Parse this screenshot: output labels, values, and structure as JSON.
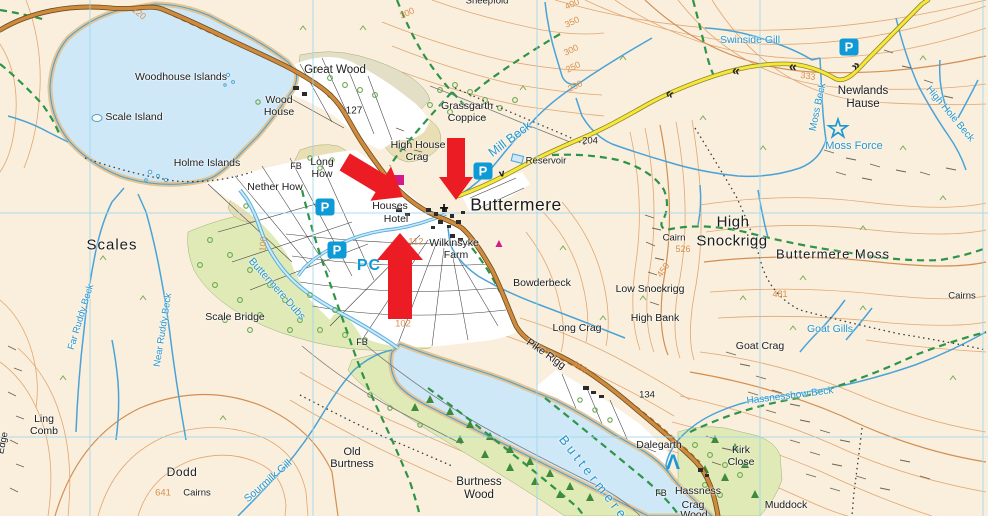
{
  "colors": {
    "land": "#f9efdc",
    "water": "#cfe8f7",
    "water_line": "#4aa3d8",
    "shore_tan": "#e4c493",
    "wood_green": "#dfeab6",
    "wood_grey": "#e2dfc6",
    "knoll_tan": "#e9deb4",
    "contour": "#e2a26c",
    "contour_index": "#d18a4c",
    "road_fill": "#cf8a3d",
    "road_casing": "#6b4d1e",
    "yellow_road": "#f6e83a",
    "yellow_casing": "#8f8526",
    "bridleway_green": "#2e9447",
    "footpath_black": "#3a3a3a",
    "grid_blue": "#99d6ee",
    "field_white": "#ffffff",
    "building_black": "#2b2b2b",
    "parking_blue": "#0e9ad6",
    "magenta": "#d31a8a",
    "arrow_red": "#ec1c24"
  },
  "labels": [
    {
      "t": "Woodhouse Islands",
      "x": 181,
      "y": 77
    },
    {
      "t": "Scale Island",
      "x": 134,
      "y": 117
    },
    {
      "t": "Holme Islands",
      "x": 207,
      "y": 163
    },
    {
      "t": "Wood",
      "x": 279,
      "y": 100
    },
    {
      "t": "House",
      "x": 279,
      "y": 112
    },
    {
      "t": "Great Wood",
      "x": 335,
      "y": 70,
      "s": 11.5
    },
    {
      "t": "127",
      "x": 354,
      "y": 111,
      "s": 10
    },
    {
      "t": "Grassgarth",
      "x": 467,
      "y": 106
    },
    {
      "t": "Coppice",
      "x": 467,
      "y": 118
    },
    {
      "t": "High House",
      "x": 418,
      "y": 145
    },
    {
      "t": "Crag",
      "x": 417,
      "y": 157
    },
    {
      "t": "Long",
      "x": 322,
      "y": 162
    },
    {
      "t": "How",
      "x": 322,
      "y": 174
    },
    {
      "t": "FB",
      "x": 296,
      "y": 166,
      "s": 9
    },
    {
      "t": "Nether How",
      "x": 275,
      "y": 187
    },
    {
      "t": "Houses",
      "x": 390,
      "y": 206
    },
    {
      "t": "Hotel",
      "x": 396,
      "y": 219
    },
    {
      "t": "Buttermere",
      "x": 516,
      "y": 205,
      "s": 17.5,
      "ls": 0.5
    },
    {
      "t": "Wilkinsyke",
      "x": 454,
      "y": 243
    },
    {
      "t": "Farm",
      "x": 456,
      "y": 255
    },
    {
      "t": "Bowderbeck",
      "x": 542,
      "y": 283
    },
    {
      "t": "Reservoir",
      "x": 546,
      "y": 161,
      "s": 9.5
    },
    {
      "t": "204",
      "x": 590,
      "y": 141,
      "s": 9.5
    },
    {
      "t": "Swinside Gill",
      "x": 750,
      "y": 40,
      "cls": "water"
    },
    {
      "t": "Newlands",
      "x": 863,
      "y": 91,
      "s": 11.5
    },
    {
      "t": "Hause",
      "x": 863,
      "y": 104,
      "s": 11.5
    },
    {
      "t": "Moss Force",
      "x": 854,
      "y": 146,
      "cls": "water",
      "s": 11
    },
    {
      "t": "Moss Beck",
      "x": 818,
      "y": 107,
      "cls": "water",
      "s": 10,
      "r": -78
    },
    {
      "t": "High Hole Beck",
      "x": 950,
      "y": 114,
      "cls": "water",
      "s": 10,
      "r": 50
    },
    {
      "t": "High",
      "x": 733,
      "y": 222,
      "s": 15,
      "ls": 0.5
    },
    {
      "t": "Snockrigg",
      "x": 732,
      "y": 241,
      "s": 15,
      "ls": 0.5
    },
    {
      "t": "Cairn",
      "x": 674,
      "y": 238,
      "s": 9.5
    },
    {
      "t": "Buttermere Moss",
      "x": 833,
      "y": 254,
      "s": 13,
      "ls": 1
    },
    {
      "t": "Cairns",
      "x": 962,
      "y": 296,
      "s": 9.5
    },
    {
      "t": "Goat Gills",
      "x": 830,
      "y": 329,
      "cls": "water"
    },
    {
      "t": "Goat Crag",
      "x": 760,
      "y": 346
    },
    {
      "t": "Low Snockrigg",
      "x": 650,
      "y": 289
    },
    {
      "t": "High Bank",
      "x": 655,
      "y": 318
    },
    {
      "t": "Long Crag",
      "x": 577,
      "y": 328
    },
    {
      "t": "Pike Rigg",
      "x": 546,
      "y": 354,
      "r": 35
    },
    {
      "t": "134",
      "x": 647,
      "y": 395,
      "s": 9.5
    },
    {
      "t": "Scale Bridge",
      "x": 235,
      "y": 317
    },
    {
      "t": "Scales",
      "x": 112,
      "y": 245,
      "s": 15,
      "ls": 1
    },
    {
      "t": "Buttermere Dubs",
      "x": 277,
      "y": 289,
      "cls": "water",
      "r": 48
    },
    {
      "t": "Far Ruddy Beck",
      "x": 81,
      "y": 317,
      "cls": "water",
      "s": 9.5,
      "r": -73
    },
    {
      "t": "Near Ruddy Beck",
      "x": 163,
      "y": 330,
      "cls": "water",
      "s": 9.5,
      "r": -81
    },
    {
      "t": "Sourmilk Gill",
      "x": 268,
      "y": 481,
      "cls": "water",
      "r": -41
    },
    {
      "t": "Ling",
      "x": 44,
      "y": 419
    },
    {
      "t": "Comb",
      "x": 44,
      "y": 431
    },
    {
      "t": "Dodd",
      "x": 182,
      "y": 472,
      "s": 12,
      "ls": 0.5
    },
    {
      "t": "641",
      "x": 163,
      "y": 493,
      "cls": "contour-lbl",
      "s": 9.5
    },
    {
      "t": "Cairns",
      "x": 197,
      "y": 493,
      "s": 9.5
    },
    {
      "t": "Old",
      "x": 352,
      "y": 452,
      "s": 11
    },
    {
      "t": "Burtness",
      "x": 352,
      "y": 464,
      "s": 11
    },
    {
      "t": "Burtness",
      "x": 479,
      "y": 482,
      "s": 11.5
    },
    {
      "t": "Wood",
      "x": 479,
      "y": 495,
      "s": 11.5
    },
    {
      "t": "Buttermere",
      "x": 594,
      "y": 478,
      "cls": "water",
      "s": 13,
      "r": 52,
      "ls": 4
    },
    {
      "t": "Dalegarth",
      "x": 659,
      "y": 445
    },
    {
      "t": "FB",
      "x": 661,
      "y": 493,
      "s": 9
    },
    {
      "t": "Hassness",
      "x": 698,
      "y": 491
    },
    {
      "t": "Crag",
      "x": 693,
      "y": 505
    },
    {
      "t": "Wood",
      "x": 694,
      "y": 515
    },
    {
      "t": "Muddock",
      "x": 786,
      "y": 505
    },
    {
      "t": "Kirk",
      "x": 741,
      "y": 450
    },
    {
      "t": "Close",
      "x": 741,
      "y": 462
    },
    {
      "t": "Hassnesshow Beck",
      "x": 790,
      "y": 396,
      "cls": "water",
      "s": 10,
      "r": -7
    },
    {
      "t": "PC",
      "x": 369,
      "y": 266,
      "cls": "blue-label",
      "s": 16,
      "ls": 1
    },
    {
      "t": "112",
      "x": 416,
      "y": 242,
      "cls": "contour-lbl",
      "s": 9.5
    },
    {
      "t": "102",
      "x": 403,
      "y": 324,
      "cls": "contour-lbl",
      "s": 9.5
    },
    {
      "t": "100",
      "x": 263,
      "y": 244,
      "cls": "contour-lbl",
      "s": 9,
      "r": -85
    },
    {
      "t": "120",
      "x": 139,
      "y": 13,
      "cls": "contour-lbl",
      "s": 9,
      "r": 38
    },
    {
      "t": "120",
      "x": 580,
      "y": 367,
      "cls": "contour-lbl",
      "s": 9,
      "r": 33
    },
    {
      "t": "333",
      "x": 808,
      "y": 76,
      "cls": "contour-lbl",
      "s": 9,
      "r": 8
    },
    {
      "t": "300",
      "x": 407,
      "y": 13,
      "cls": "contour-lbl",
      "s": 9,
      "r": -25
    },
    {
      "t": "400",
      "x": 572,
      "y": 4,
      "cls": "contour-lbl",
      "s": 9,
      "r": -25
    },
    {
      "t": "350",
      "x": 572,
      "y": 22,
      "cls": "contour-lbl",
      "s": 9,
      "r": -25
    },
    {
      "t": "300",
      "x": 571,
      "y": 50,
      "cls": "contour-lbl",
      "s": 9,
      "r": -25
    },
    {
      "t": "250",
      "x": 573,
      "y": 67,
      "cls": "contour-lbl",
      "s": 9,
      "r": -25
    },
    {
      "t": "200",
      "x": 575,
      "y": 86,
      "cls": "contour-lbl",
      "s": 9,
      "r": -25
    },
    {
      "t": "526",
      "x": 683,
      "y": 249,
      "cls": "contour-lbl",
      "s": 9
    },
    {
      "t": "481",
      "x": 780,
      "y": 294,
      "cls": "contour-lbl",
      "s": 9
    },
    {
      "t": "450",
      "x": 663,
      "y": 270,
      "cls": "contour-lbl",
      "s": 9,
      "r": -55
    },
    {
      "t": "Sheepfold",
      "x": 487,
      "y": 1,
      "s": 9.5
    },
    {
      "t": "Edge",
      "x": 3,
      "y": 443,
      "s": 9.5,
      "r": -78
    },
    {
      "t": "Mill Beck",
      "x": 510,
      "y": 139,
      "cls": "water",
      "s": 12.5,
      "r": -37
    },
    {
      "t": "FB",
      "x": 362,
      "y": 342,
      "s": 9
    }
  ],
  "icons": [
    {
      "name": "parking-icon",
      "glyph": "P",
      "x": 325,
      "y": 207,
      "cls": "p-icon"
    },
    {
      "name": "parking-icon",
      "glyph": "P",
      "x": 337,
      "y": 250,
      "cls": "p-icon"
    },
    {
      "name": "parking-icon",
      "glyph": "P",
      "x": 483,
      "y": 171,
      "cls": "p-icon"
    },
    {
      "name": "parking-icon",
      "glyph": "P",
      "x": 849,
      "y": 47,
      "cls": "p-icon"
    },
    {
      "name": "waterfall-star-icon",
      "glyph": "☆",
      "x": 838,
      "y": 129,
      "cls": "star-icon"
    },
    {
      "name": "campsite-tent-icon",
      "glyph": "Λ",
      "x": 673,
      "y": 463,
      "cls": "tent-icon"
    },
    {
      "name": "church-cross-icon",
      "glyph": "+",
      "x": 444,
      "y": 209,
      "cls": "cross-icon"
    },
    {
      "name": "caravan-site-icon",
      "glyph": "▲",
      "x": 499,
      "y": 243,
      "cls": "magenta-icon"
    },
    {
      "name": "gradient-chevron-icon",
      "glyph": "«",
      "x": 670,
      "y": 93,
      "cls": "chev",
      "r": 18
    },
    {
      "name": "gradient-chevron-icon",
      "glyph": "«",
      "x": 736,
      "y": 70,
      "cls": "chev",
      "r": 8
    },
    {
      "name": "gradient-chevron-icon",
      "glyph": "«",
      "x": 793,
      "y": 66,
      "cls": "chev",
      "r": 5
    },
    {
      "name": "gradient-chevron-icon",
      "glyph": "»",
      "x": 855,
      "y": 65,
      "cls": "chev",
      "r": -42
    },
    {
      "name": "flow-arrow-icon",
      "glyph": "v",
      "x": 502,
      "y": 174,
      "cls": "flow",
      "r": -12
    },
    {
      "name": "hotel-building-icon",
      "glyph": "",
      "x": 399,
      "y": 180,
      "cls": "pink-sq"
    }
  ],
  "annotations": {
    "color": "#ec1c24",
    "arrows": [
      {
        "name": "red-arrow-southeast",
        "points": "0,0 -26,-20 -26,-10 -68,-10 -68,10 -26,10 -26,20",
        "transform": "translate(403,197) rotate(31)"
      },
      {
        "name": "red-arrow-down",
        "points": "0,0 -23,-17 -23,-9 -62,-9 -62,9 -23,9 -23,17",
        "transform": "translate(456,200) rotate(90)"
      },
      {
        "name": "red-arrow-up",
        "points": "0,0 -27,-23 -27,-12 -86,-12 -86,12 -27,12 -27,23",
        "transform": "translate(400,233) rotate(-90)"
      }
    ]
  }
}
